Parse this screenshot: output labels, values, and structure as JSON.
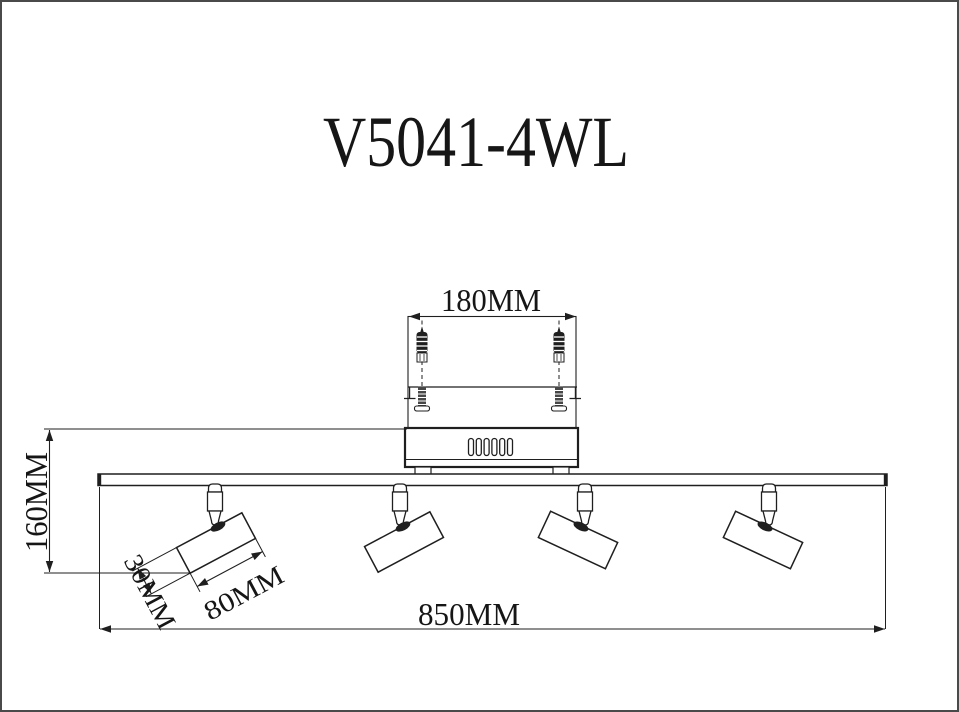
{
  "page": {
    "background": "#ffffff",
    "border_color": "#4a4a4a",
    "line_color": "#1f1f1f"
  },
  "title": "V5041-4WL",
  "drawing": {
    "type": "installation-dimension-diagram",
    "product_code": "V5041-4WL",
    "spotlight_count": 4,
    "dimensions": {
      "mounting_width": "180MM",
      "overall_height": "160MM",
      "head_width": "30MM",
      "head_length": "80MM",
      "overall_width": "850MM"
    }
  }
}
